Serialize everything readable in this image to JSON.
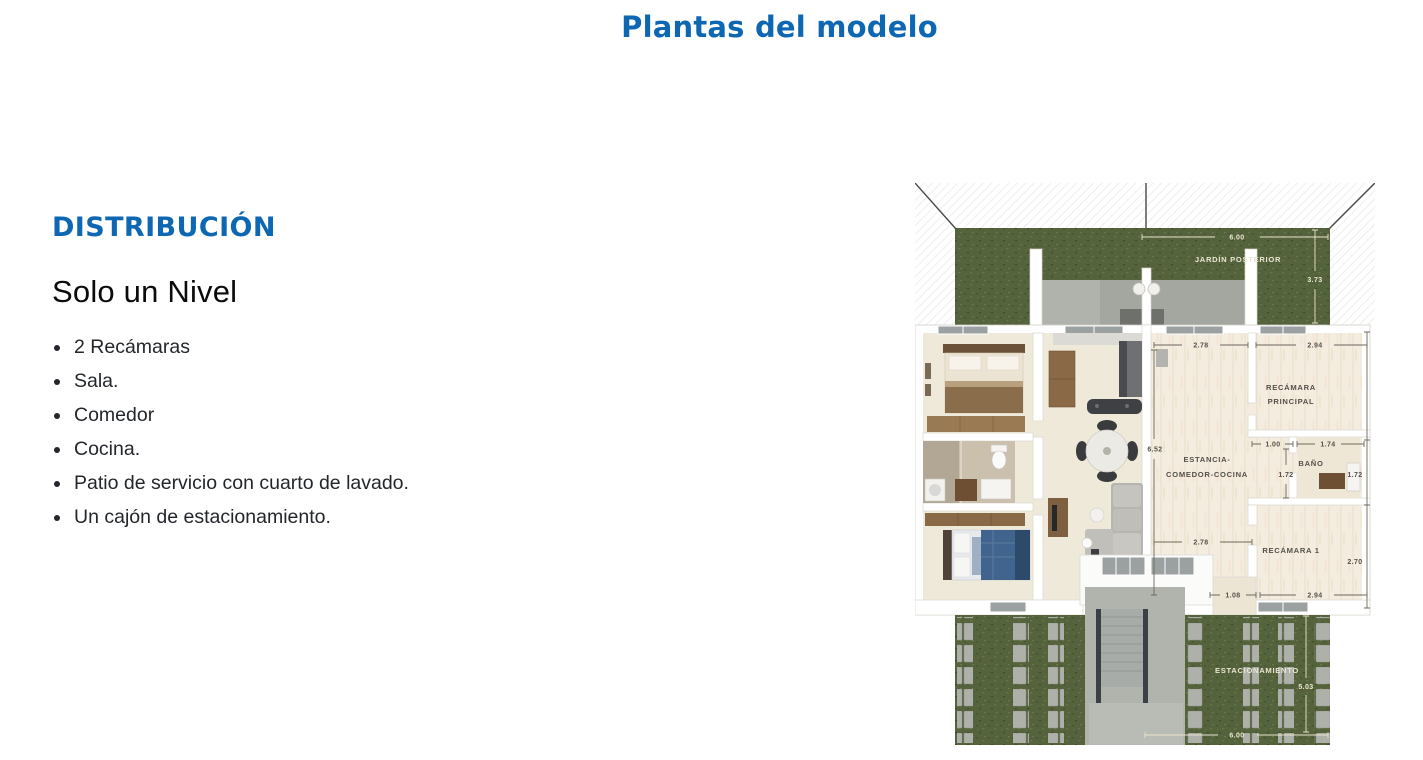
{
  "page": {
    "title": "Plantas del modelo"
  },
  "distribution": {
    "heading": "DISTRIBUCIÓN",
    "subheading": "Solo un Nivel",
    "items": [
      "2 Recámaras",
      "Sala.",
      "Comedor",
      "Cocina.",
      "Patio de servicio con cuarto de lavado.",
      "Un cajón de estacionamiento."
    ]
  },
  "floorplan": {
    "labels": {
      "jardin": "JARDÍN POSTERIOR",
      "recamara_principal": {
        "line1": "RECÁMARA",
        "line2": "PRINCIPAL"
      },
      "estancia": {
        "line1": "ESTANCIA-",
        "line2": "COMEDOR-COCINA"
      },
      "bano": "BAÑO",
      "recamara_1": "RECÁMARA 1",
      "estacionamiento": "ESTACIONAMIENTO"
    },
    "dimensions": {
      "jardin_width": "6.00",
      "jardin_depth": "3.73",
      "estancia_width_top": "2.78",
      "recamara_principal_width": "2.94",
      "interior_depth": "6.52",
      "bano_left_width": "1.00",
      "bano_width": "1.74",
      "bano_depth_left": "1.72",
      "bano_depth_right": "1.72",
      "estancia_width_bottom": "2.78",
      "recamara_1_depth": "2.70",
      "patio_servicio_width": "1.08",
      "recamara_1_width": "2.94",
      "estacionamiento_depth": "5.03",
      "estacionamiento_width": "6.00"
    }
  },
  "colors": {
    "accent": "#0e67b2",
    "heading_text": "#0b0b0b",
    "body_text": "#23272b",
    "grass": "#55633c",
    "floor_left": "#efe9da",
    "floor_right": "#f3ecdf",
    "paver": "#adb1aa",
    "wall": "#ffffff",
    "dim_dark": "#56524a",
    "dim_light": "#ece8d3"
  }
}
